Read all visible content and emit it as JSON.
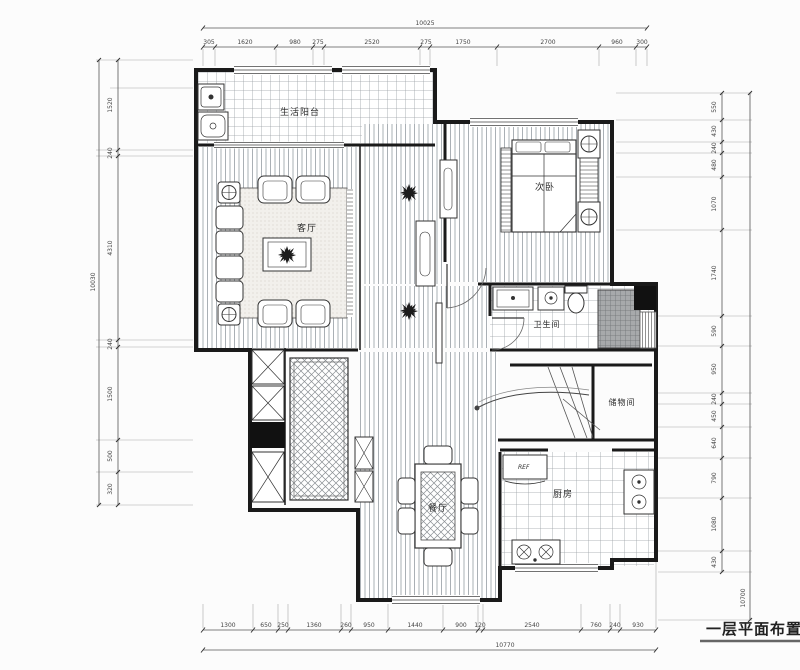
{
  "title": "一层平面布置图",
  "rooms": {
    "balcony": "生活阳台",
    "living": "客厅",
    "bedroom": "次卧",
    "bathroom": "卫生间",
    "storage": "储物间",
    "kitchen": "厨房",
    "dining": "餐厅"
  },
  "appliances": {
    "fridge": "REF"
  },
  "colors": {
    "wall": "#1a1a1a",
    "dimline": "#555555",
    "floor": "#ffffff"
  },
  "dims": {
    "top_total": "10025",
    "top_segments": [
      "305",
      "1620",
      "980",
      "275",
      "2520",
      "275",
      "1750",
      "2700",
      "960",
      "300"
    ],
    "bottom_segments": [
      "1300",
      "650",
      "250",
      "1360",
      "260",
      "950",
      "1440",
      "900",
      "120",
      "2540",
      "760",
      "240",
      "930"
    ],
    "bottom_total": "10770",
    "left_total": "10030",
    "left_segments": [
      "1520",
      "240",
      "4310",
      "240",
      "1500",
      "500",
      "320"
    ],
    "right_total": "10700",
    "right_segments": [
      "550",
      "430",
      "240",
      "480",
      "1070",
      "1740",
      "590",
      "950",
      "240",
      "450",
      "640",
      "790",
      "1080",
      "430"
    ]
  }
}
